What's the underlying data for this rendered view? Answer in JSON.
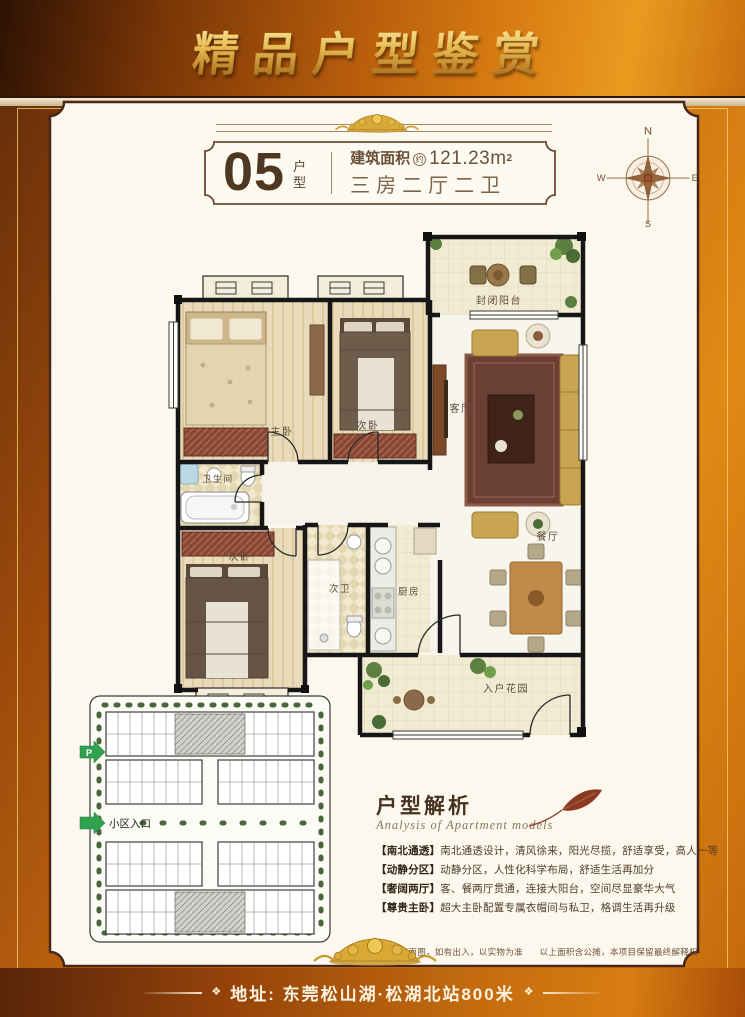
{
  "banner": {
    "title": "精品户型鉴赏"
  },
  "unit": {
    "number": "05",
    "type_vertical": "户型",
    "area_label": "建筑面积",
    "area_approx": "约",
    "area_value": "121.23m",
    "area_sup": "2",
    "layout": "三房二厅二卫"
  },
  "compass": {
    "n": "N",
    "e": "E",
    "s": "S",
    "w": "W"
  },
  "floorplan": {
    "rooms": [
      "封闭阳台",
      "客厅",
      "主卧",
      "次卧",
      "卫生间",
      "次卧",
      "次卫",
      "厨房",
      "餐厅",
      "入户花园"
    ]
  },
  "siteplan": {
    "parking": "P",
    "entrance": "小区入口"
  },
  "analysis": {
    "title": "户型解析",
    "subtitle": "Analysis of Apartment models",
    "items": [
      {
        "tag": "【南北通透】",
        "text": "南北通透设计，清风徐来，阳光尽揽，舒适享受，高人一等"
      },
      {
        "tag": "【动静分区】",
        "text": "动静分区，人性化科学布局，舒适生活再加分"
      },
      {
        "tag": "【奢阔两厅】",
        "text": "客、餐两厅贯通，连接大阳台，空间尽显豪华大气"
      },
      {
        "tag": "【尊贵主卧】",
        "text": "超大主卧配置专属衣帽间与私卫，格调生活再升级"
      }
    ]
  },
  "footer": {
    "disclaimer_left": "以上平面图，如有出入，以实物为准",
    "disclaimer_right": "以上面积含公摊，本项目保留最终解释权",
    "address": "地址: 东莞松山湖·松湖北站800米",
    "ornament_glyph": "❖"
  },
  "colors": {
    "accent_gold": "#d9a937",
    "bg_orange": "#c86f10",
    "panel_cream": "#fcf8ee",
    "entrance_green": "#2fa14f",
    "wall_black": "#161616"
  }
}
